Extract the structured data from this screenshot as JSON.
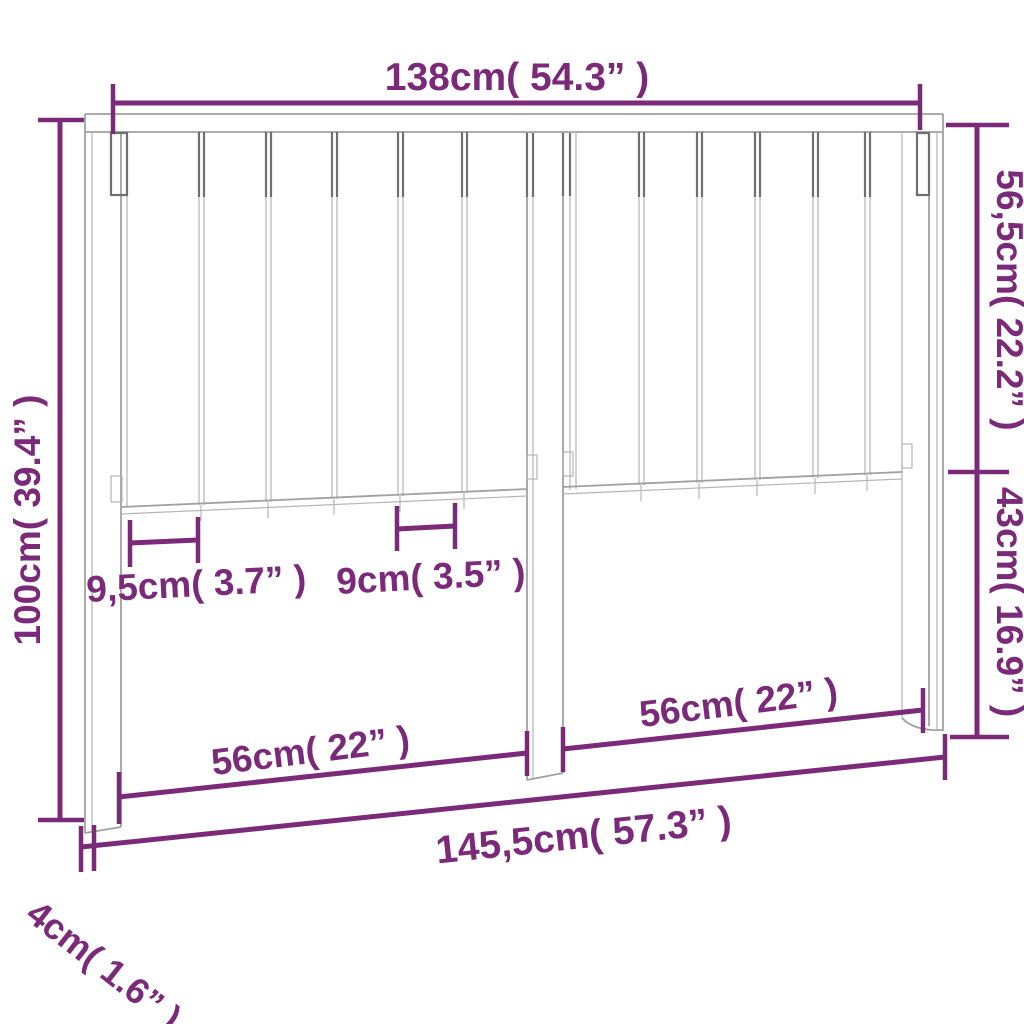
{
  "diagram": {
    "subject": "headboard-dimension-drawing",
    "colors": {
      "dimension_accent": "#7b2a79",
      "drawing_outline": "#a0a0a0",
      "background": "#ffffff"
    },
    "labels": {
      "top_width": "138cm( 54.3” )",
      "upper_height": "56,5cm( 22.2” )",
      "lower_height": "43cm( 16.9” )",
      "total_height": "100cm( 39.4” )",
      "slat_width": "9,5cm( 3.7” )",
      "slat_spacing": "9cm( 3.5” )",
      "left_section_width": "56cm( 22” )",
      "right_section_width": "56cm( 22” )",
      "total_width": "145,5cm( 57.3” )",
      "board_thickness": "4cm( 1.6” )"
    }
  }
}
